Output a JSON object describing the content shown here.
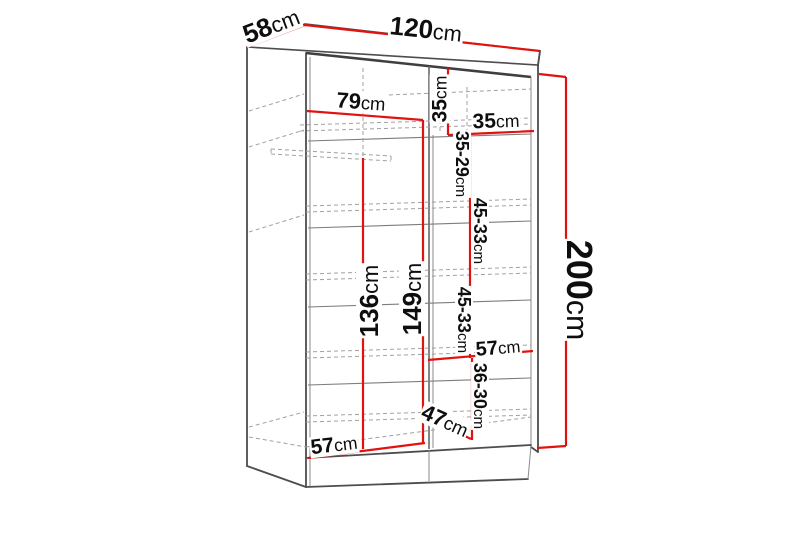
{
  "figure": {
    "type": "furniture-dimension-diagram",
    "subject": "wardrobe with shelves and hanging rail",
    "units": "cm"
  },
  "colors": {
    "dimension_line": "#e01311",
    "structure_line": "#7d7d7d",
    "outline": "#4d4d4d",
    "dash": "#a0a0a0",
    "text": "#0e0e0e",
    "background": "#ffffff"
  },
  "labels": {
    "overall_width": {
      "num": "120",
      "unit": "cm"
    },
    "overall_depth": {
      "num": "58",
      "unit": "cm"
    },
    "overall_height": {
      "num": "200",
      "unit": "cm"
    },
    "left_section_width": {
      "num": "79",
      "unit": "cm"
    },
    "top_section_height": {
      "num": "35",
      "unit": "cm"
    },
    "right_section_width": {
      "num": "35",
      "unit": "cm"
    },
    "right_gap_top": {
      "num": "35-29",
      "unit": "cm"
    },
    "right_gap_upper": {
      "num": "45-33",
      "unit": "cm"
    },
    "right_gap_lower": {
      "num": "45-33",
      "unit": "cm"
    },
    "hanging_space_height": {
      "num": "136",
      "unit": "cm"
    },
    "middle_column_height": {
      "num": "149",
      "unit": "cm"
    },
    "bottom_right_shelf_width": {
      "num": "57",
      "unit": "cm"
    },
    "bottom_section_height": {
      "num": "36-30",
      "unit": "cm"
    },
    "bottom_shelf_depth": {
      "num": "47",
      "unit": "cm"
    },
    "bottom_left_shelf_width": {
      "num": "57",
      "unit": "cm"
    }
  }
}
